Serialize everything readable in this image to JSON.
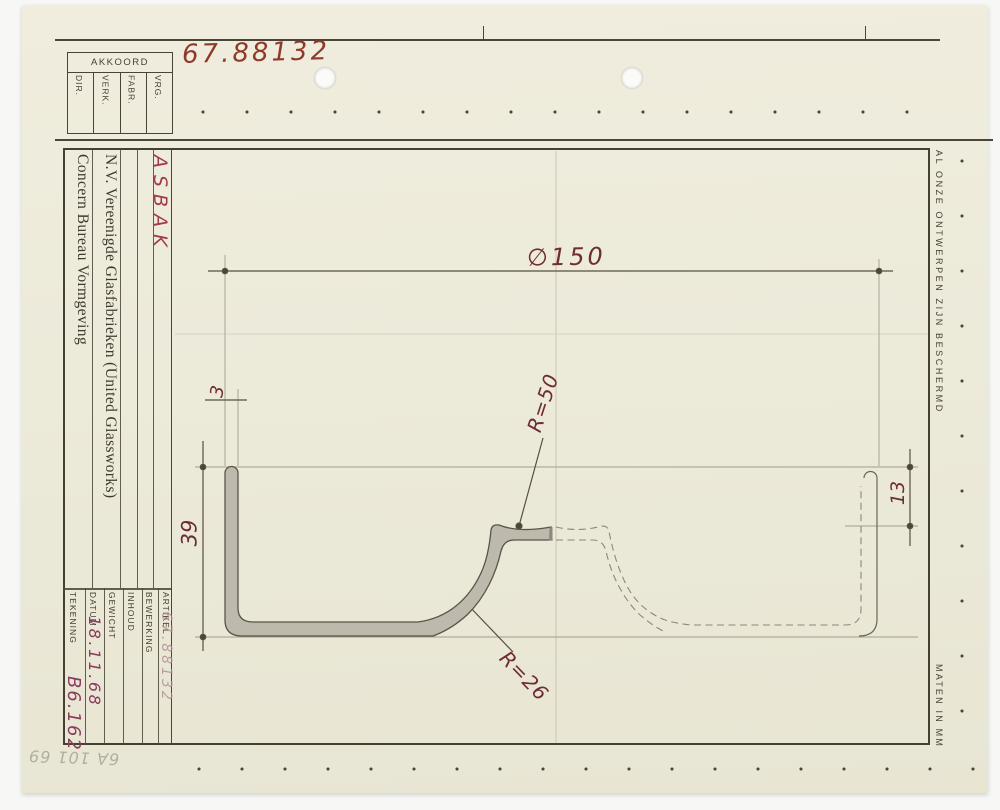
{
  "drawing_number": "67.88132",
  "approval_block": {
    "header": "AKKOORD",
    "columns": [
      "DIR.",
      "VERK.",
      "FABR.",
      "VRG."
    ]
  },
  "sidebar": {
    "product": "ASBAK",
    "company": "N.V. Vereenigde Glasfabrieken (United Glassworks)",
    "department": "Concern Bureau Vormgeving"
  },
  "title_block": {
    "fields": [
      {
        "label": "TEKENING",
        "value": "B6.162"
      },
      {
        "label": "DATUM",
        "value": "18.11.68"
      },
      {
        "label": "GEWICHT",
        "value": ""
      },
      {
        "label": "INHOUD",
        "value": ""
      },
      {
        "label": "BEWERKING",
        "value": ""
      },
      {
        "label": "ARTIKEL",
        "value": "67.88132"
      }
    ]
  },
  "margins": {
    "protection_notice": "AL ONZE ONTWERPEN ZIJN BESCHERMD",
    "units_note": "MATEN IN MM",
    "pencil_note": "6A 101 69"
  },
  "dimensions": {
    "diameter": "∅150",
    "height": "39",
    "rim_depth": "13",
    "wall_thickness": "3",
    "radius_inner": "R=50",
    "radius_outer": "R=26"
  },
  "colors": {
    "paper": "#ecead9",
    "ink": "#454032",
    "handwriting_red": "#8f3a28",
    "dimension_red": "#6f2b36",
    "value_purple": "#8b3c5e",
    "pencil_gray": "#b3aea1"
  }
}
